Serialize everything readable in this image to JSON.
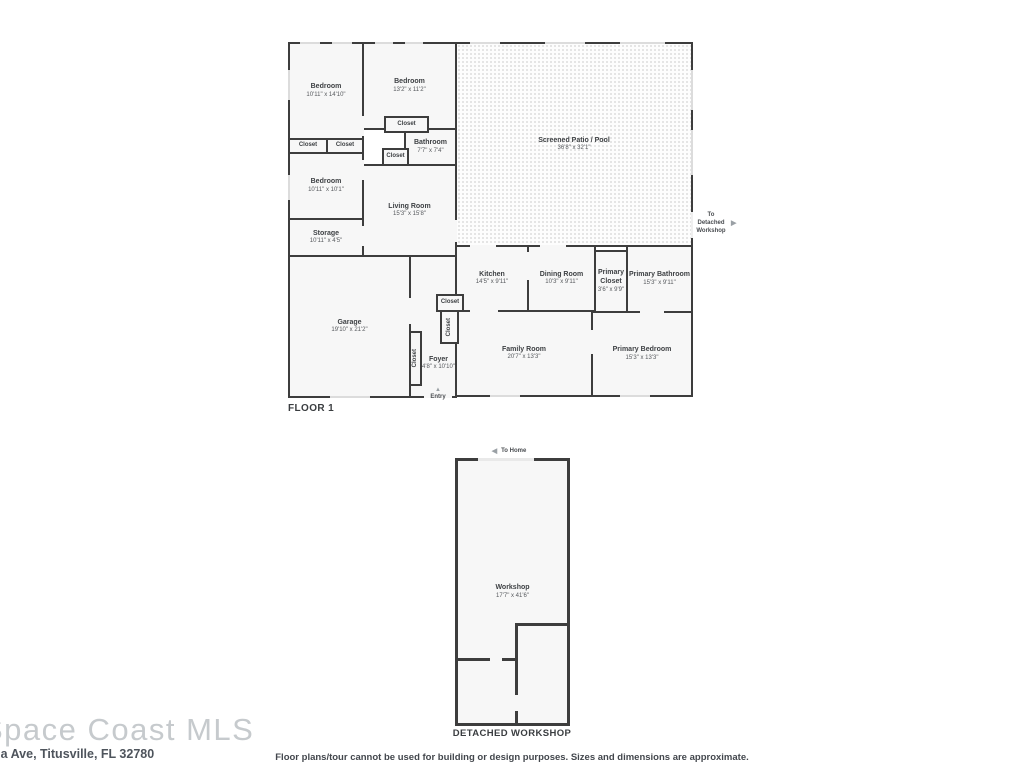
{
  "branding": {
    "logo": "Space Coast MLS",
    "address": "na Ave, Titusville, FL 32780"
  },
  "disclaimer": "Floor plans/tour cannot be used for building or design purposes. Sizes and dimensions are approximate.",
  "icons": {
    "arrow_right": "▶",
    "arrow_left": "◀",
    "arrow_up": "▲"
  },
  "floor1": {
    "title": "FLOOR 1",
    "closet_label": "Closet",
    "entry_label": "Entry",
    "to_workshop_label": "To Detached Workshop",
    "rooms": {
      "bedroom_top_left": {
        "name": "Bedroom",
        "dims": "10'11\" x 14'10\""
      },
      "bedroom_top_mid": {
        "name": "Bedroom",
        "dims": "13'2\" x 11'2\""
      },
      "bedroom_left": {
        "name": "Bedroom",
        "dims": "10'11\" x 10'1\""
      },
      "bathroom": {
        "name": "Bathroom",
        "dims": "7'7\" x 7'4\""
      },
      "living_room": {
        "name": "Living Room",
        "dims": "15'3\" x 15'8\""
      },
      "storage": {
        "name": "Storage",
        "dims": "10'11\" x 4'5\""
      },
      "patio": {
        "name": "Screened Patio / Pool",
        "dims": "36'8\" x 32'1\""
      },
      "kitchen": {
        "name": "Kitchen",
        "dims": "14'5\" x 9'11\""
      },
      "dining_room": {
        "name": "Dining Room",
        "dims": "10'3\" x 9'11\""
      },
      "primary_closet": {
        "name": "Primary Closet",
        "dims": "3'6\" x 9'9\""
      },
      "primary_bathroom": {
        "name": "Primary Bathroom",
        "dims": "15'3\" x 9'11\""
      },
      "garage": {
        "name": "Garage",
        "dims": "19'10\" x 21'2\""
      },
      "foyer": {
        "name": "Foyer",
        "dims": "4'8\" x 10'10\""
      },
      "family_room": {
        "name": "Family Room",
        "dims": "20'7\" x 13'3\""
      },
      "primary_bedroom": {
        "name": "Primary Bedroom",
        "dims": "15'3\" x 13'3\""
      }
    }
  },
  "workshop": {
    "title": "DETACHED WORKSHOP",
    "to_home_label": "To Home",
    "room": {
      "name": "Workshop",
      "dims": "17'7\" x 41'6\""
    }
  }
}
